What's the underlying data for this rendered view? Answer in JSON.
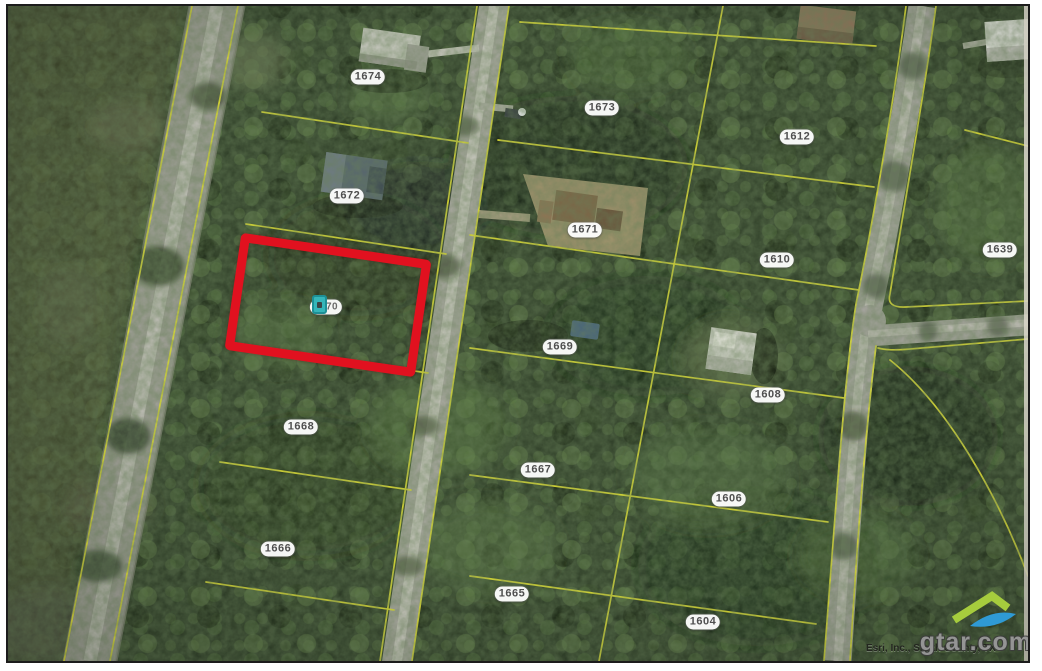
{
  "map": {
    "type": "aerial-parcel-map",
    "attribution": "Esri, Inc., Smith County, TX",
    "watermark": "gtar.com",
    "selected_parcel": {
      "id": "1670",
      "highlight_color": "#e1111f",
      "marker_color": "#35b6ba"
    },
    "parcels": [
      {
        "id": "1674",
        "x": 360,
        "y": 71
      },
      {
        "id": "1673",
        "x": 594,
        "y": 102
      },
      {
        "id": "1612",
        "x": 789,
        "y": 131
      },
      {
        "id": "1672",
        "x": 339,
        "y": 190
      },
      {
        "id": "1671",
        "x": 577,
        "y": 224
      },
      {
        "id": "1610",
        "x": 769,
        "y": 254
      },
      {
        "id": "1639",
        "x": 992,
        "y": 244
      },
      {
        "id": "1669",
        "x": 552,
        "y": 341
      },
      {
        "id": "1608",
        "x": 760,
        "y": 389
      },
      {
        "id": "1668",
        "x": 293,
        "y": 421
      },
      {
        "id": "1667",
        "x": 530,
        "y": 464
      },
      {
        "id": "1606",
        "x": 721,
        "y": 493
      },
      {
        "id": "1666",
        "x": 270,
        "y": 543
      },
      {
        "id": "1665",
        "x": 504,
        "y": 588
      },
      {
        "id": "1604",
        "x": 695,
        "y": 616
      }
    ],
    "colors": {
      "parcel_line": "#e6e432",
      "label_bg": "#ffffff",
      "label_text": "#4f4f4f",
      "logo_green": "#a6cc3d",
      "logo_blue": "#2f9ad4"
    }
  }
}
